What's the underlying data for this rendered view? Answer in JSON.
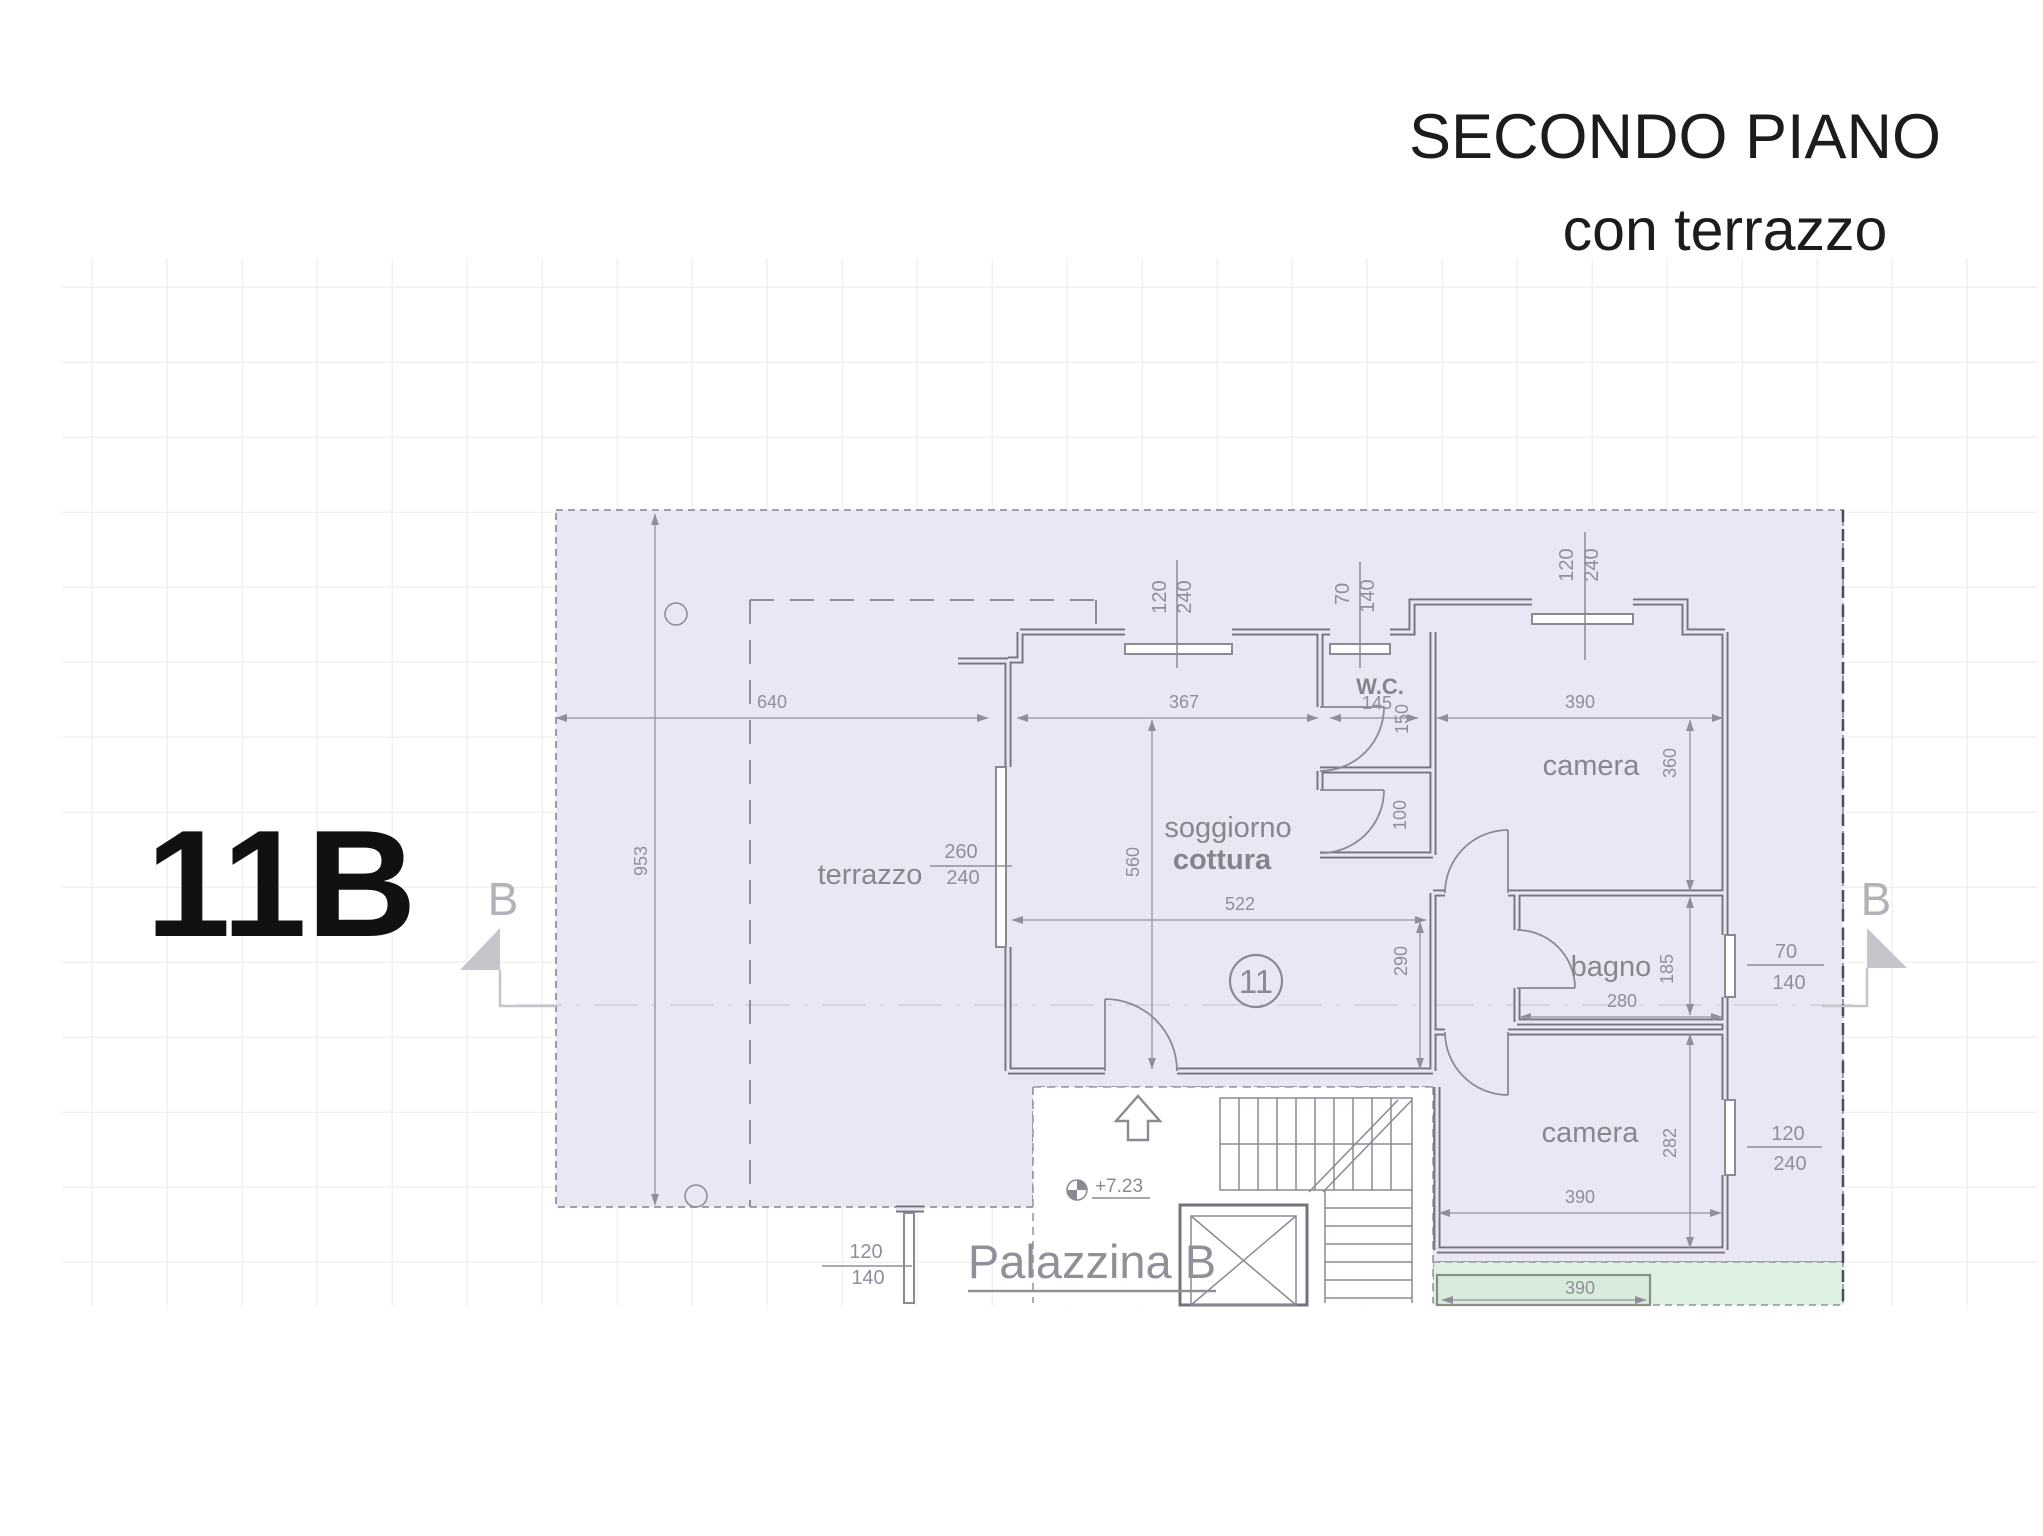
{
  "title": {
    "line1": "SECONDO PIANO",
    "line2": "con terrazzo"
  },
  "unit_label": "11B",
  "unit_number": "11",
  "section": {
    "left": "B",
    "right": "B"
  },
  "building_label": "Palazzina B",
  "elevation": "+7.23",
  "rooms": {
    "terrazzo": "terrazzo",
    "soggiorno_line1": "soggiorno",
    "soggiorno_line2": "cottura",
    "wc": "W.C.",
    "camera_top": "camera",
    "bagno": "bagno",
    "camera_bottom": "camera"
  },
  "dimensions": {
    "terrace_width": "640",
    "terrace_depth": "953",
    "soggiorno_top": "367",
    "soggiorno_width": "522",
    "soggiorno_depth": "560",
    "wc_width": "145",
    "wc_depth": "150",
    "hall_opening": "100",
    "ingresso_depth": "290",
    "camera_top_width": "390",
    "camera_top_depth": "360",
    "bagno_width": "280",
    "bagno_depth": "185",
    "camera_bottom_width": "390",
    "camera_bottom_depth": "282",
    "balcony_width": "390"
  },
  "windows": {
    "terrace_door_w": "260",
    "terrace_door_h": "240",
    "soggiorno_win_w": "120",
    "soggiorno_win_h": "240",
    "wc_win_w": "70",
    "wc_win_h": "140",
    "camera_top_win_w": "120",
    "camera_top_win_h": "240",
    "bagno_win_w": "70",
    "bagno_win_h": "140",
    "camera_east_win_w": "120",
    "camera_east_win_h": "240",
    "stair_win_w": "120",
    "stair_win_h": "140"
  },
  "colors": {
    "plan_fill": "#e9e7f3",
    "balcony_fill": "#def0e2",
    "wall": "#75727e",
    "annotation": "#908e9a",
    "marker": "#b3b1b9"
  }
}
